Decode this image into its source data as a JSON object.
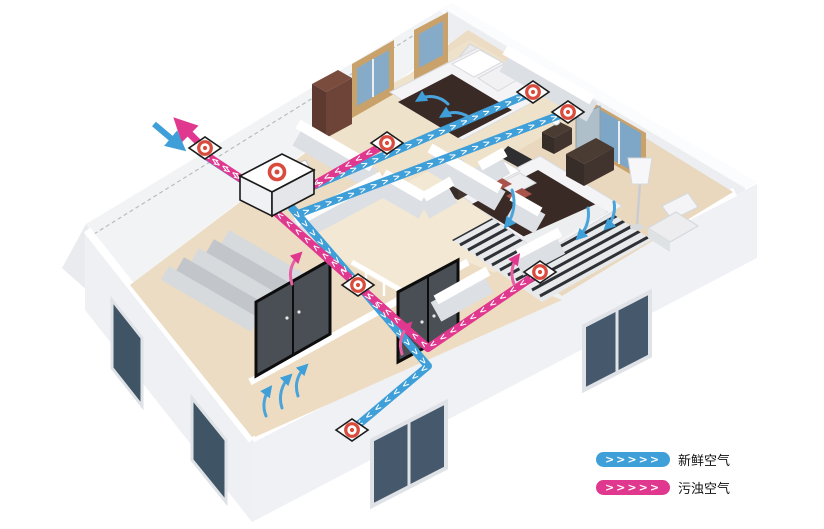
{
  "legend": {
    "items": [
      {
        "id": "fresh-air",
        "chevrons": ">>>>>",
        "label": "新鲜空气",
        "color": "#3f9fd8"
      },
      {
        "id": "polluted-air",
        "chevrons": ">>>>>",
        "label": "污浊空气",
        "color": "#e0388e"
      }
    ]
  },
  "diagram": {
    "colors": {
      "fresh_duct": "#3f9fd8",
      "polluted_duct": "#e0388e",
      "vent_ring": "#d94b3c",
      "floor": "#ecdcc3",
      "wall_face": "#dfe2e6"
    },
    "icons": [
      "heat-recovery-unit-icon",
      "exterior-wall-vent-icon",
      "supply-vent-icon",
      "extract-vent-icon",
      "fresh-air-intake-arrow-icon",
      "polluted-air-exhaust-arrow-icon"
    ]
  }
}
